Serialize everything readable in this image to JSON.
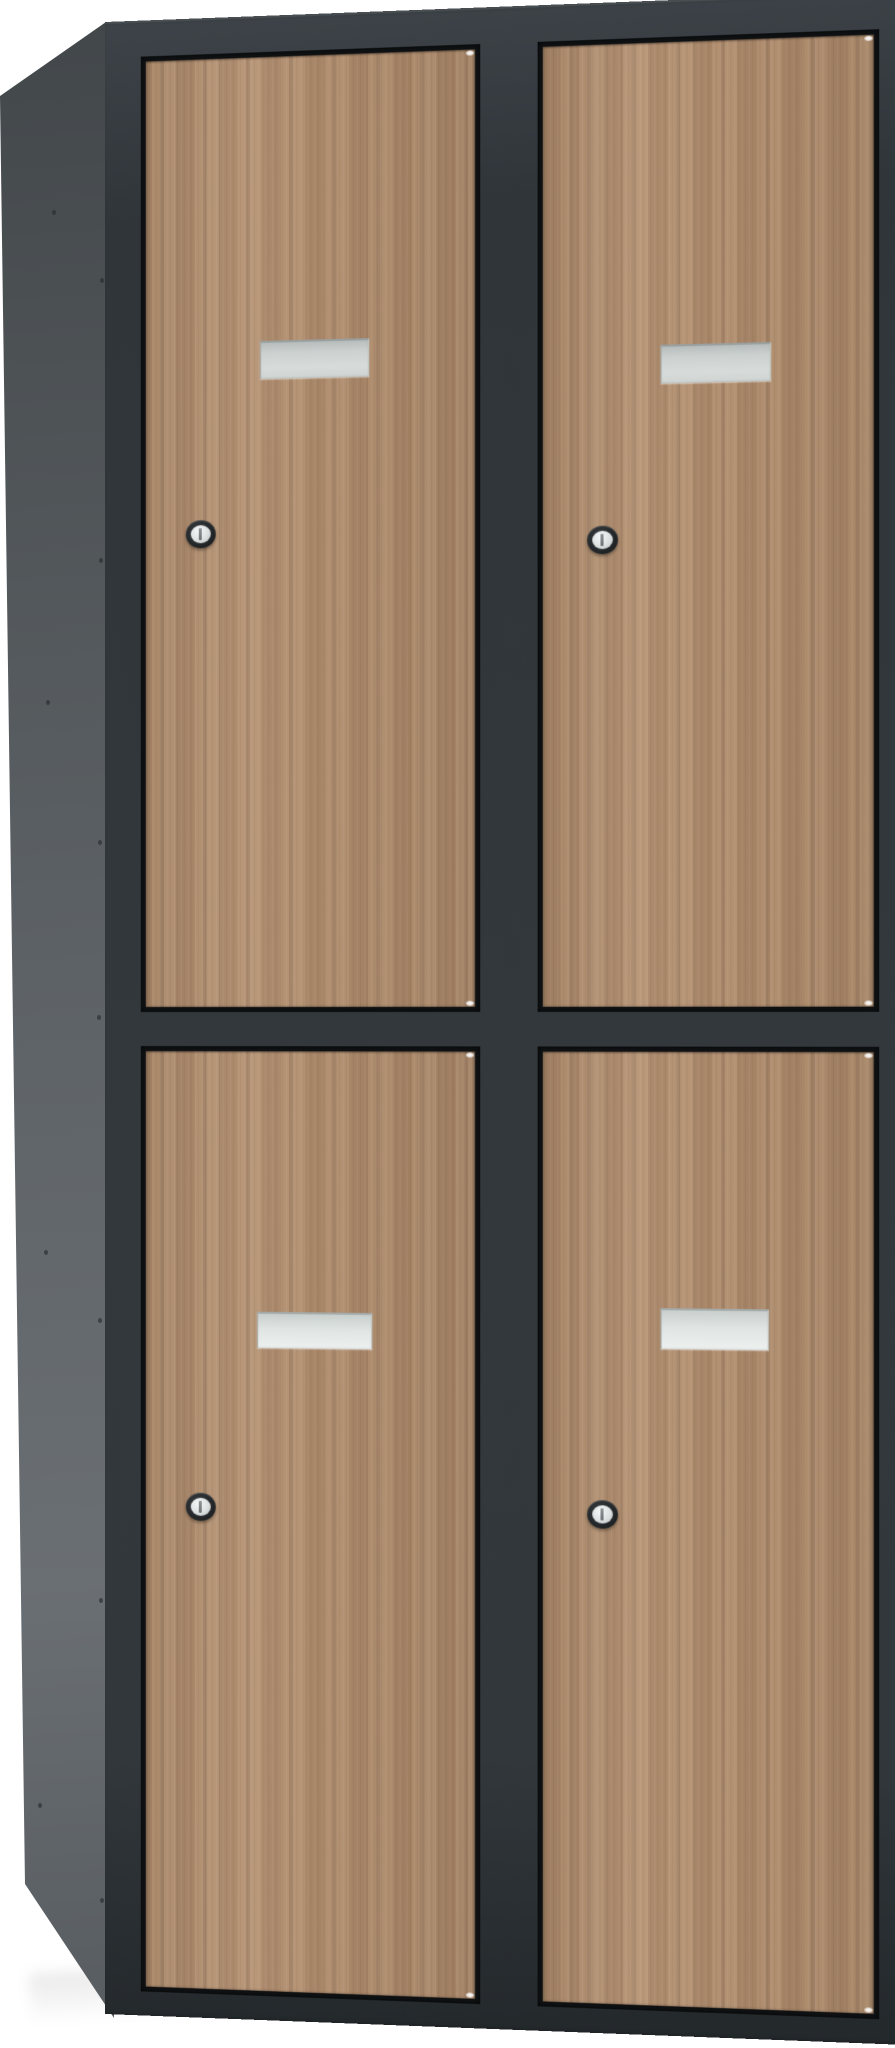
{
  "scene": {
    "description": "Product photograph of a four-compartment locker cabinet with wooden doors, viewed from the front-left on a white background",
    "background_color": "#ffffff",
    "label": "Locker cabinet with 4 wooden doors"
  },
  "cabinet": {
    "body_color_name": "anthracite grey",
    "body_color": "#31373b",
    "gap_color": "#101315",
    "side_panel_color": "#5d6266",
    "door_color_name": "light oak wood",
    "door_color": "#b18e6f",
    "columns": 2,
    "rows": 2,
    "door_count": 4,
    "doors": [
      {
        "id": "top-left",
        "label": "Top left locker door with blank name plate and cylinder lock"
      },
      {
        "id": "top-right",
        "label": "Top right locker door with blank name plate and cylinder lock"
      },
      {
        "id": "bottom-left",
        "label": "Bottom left locker door with blank name plate and cylinder lock"
      },
      {
        "id": "bottom-right",
        "label": "Bottom right locker door with blank name plate and cylinder lock"
      }
    ],
    "name_plate": {
      "label": "Blank grey label holder",
      "color": "#d7dcda"
    },
    "lock": {
      "label": "Cylinder key lock",
      "ring_color": "#24282a",
      "cylinder_color": "#dde1e1"
    },
    "side_panel": {
      "label": "Left side panel with rivet holes",
      "rivet_color": "#282c2e"
    }
  }
}
